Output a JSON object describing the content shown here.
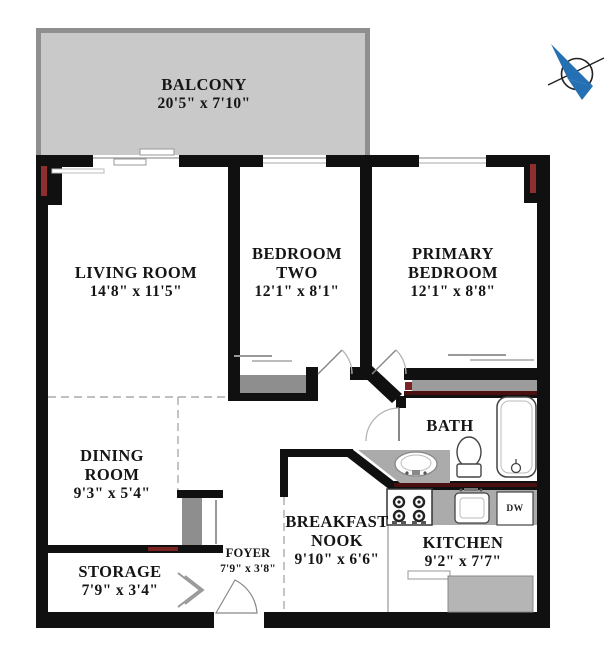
{
  "rooms": {
    "balcony": {
      "name": "BALCONY",
      "dims": "20'5\" x 7'10\""
    },
    "living": {
      "name": "LIVING ROOM",
      "dims": "14'8\" x 11'5\""
    },
    "bedroom2": {
      "line1": "BEDROOM",
      "line2": "TWO",
      "dims": "12'1\" x 8'1\""
    },
    "primary": {
      "line1": "PRIMARY",
      "line2": "BEDROOM",
      "dims": "12'1\" x 8'8\""
    },
    "dining": {
      "line1": "DINING",
      "line2": "ROOM",
      "dims": "9'3\" x 5'4\""
    },
    "bath": {
      "name": "BATH"
    },
    "storage": {
      "name": "STORAGE",
      "dims": "7'9\" x 3'4\""
    },
    "foyer": {
      "name": "FOYER",
      "dims": "7'9\" x 3'8\""
    },
    "nook": {
      "line1": "BREAKFAST",
      "line2": "NOOK",
      "dims": "9'10\" x 6'6\""
    },
    "kitchen": {
      "name": "KITCHEN",
      "dims": "9'2\" x 7'7\""
    }
  },
  "labels": {
    "dishwasher": "DW"
  },
  "colors": {
    "wall": "#101010",
    "balcony_fill": "#c9c9c9",
    "balcony_border": "#8f8f8f",
    "closet_fill": "#8e8e8e",
    "counter_fill": "#ababab",
    "fridge_fill": "#b5b5b5",
    "corner_marker_red": "#8d2f2f",
    "wall_stripe_dark_red": "#4a1010",
    "compass_blue": "#2470b3"
  }
}
